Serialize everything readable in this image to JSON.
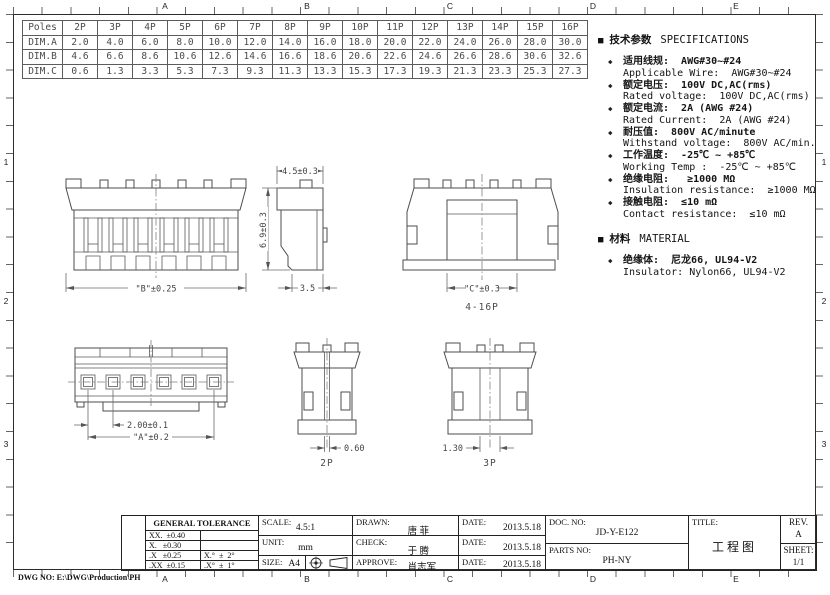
{
  "sheet": {
    "footer_dwg_no": "DWG NO: E:\\DWG\\Production\\PH",
    "zones": {
      "cols": [
        "A",
        "B",
        "C",
        "D",
        "E"
      ],
      "rows": [
        "1",
        "2",
        "3"
      ]
    }
  },
  "icons": {
    "section_marker": "■",
    "bullet": "◆"
  },
  "dim_table": {
    "header": [
      "Poles",
      "2P",
      "3P",
      "4P",
      "5P",
      "6P",
      "7P",
      "8P",
      "9P",
      "10P",
      "11P",
      "12P",
      "13P",
      "14P",
      "15P",
      "16P"
    ],
    "rows": [
      {
        "label": "DIM.A",
        "values": [
          "2.0",
          "4.0",
          "6.0",
          "8.0",
          "10.0",
          "12.0",
          "14.0",
          "16.0",
          "18.0",
          "20.0",
          "22.0",
          "24.0",
          "26.0",
          "28.0",
          "30.0"
        ]
      },
      {
        "label": "DIM.B",
        "values": [
          "4.6",
          "6.6",
          "8.6",
          "10.6",
          "12.6",
          "14.6",
          "16.6",
          "18.6",
          "20.6",
          "22.6",
          "24.6",
          "26.6",
          "28.6",
          "30.6",
          "32.6"
        ]
      },
      {
        "label": "DIM.C",
        "values": [
          "0.6",
          "1.3",
          "3.3",
          "5.3",
          "7.3",
          "9.3",
          "11.3",
          "13.3",
          "15.3",
          "17.3",
          "19.3",
          "21.3",
          "23.3",
          "25.3",
          "27.3"
        ]
      }
    ]
  },
  "specs": {
    "title_zh": "技术参数",
    "title_en": "SPECIFICATIONS",
    "items": [
      {
        "zh": "适用线规:  AWG#30~#24",
        "en": "Applicable Wire:  AWG#30~#24"
      },
      {
        "zh": "额定电压:  100V DC,AC(rms)",
        "en": "Rated voltage:  100V DC,AC(rms)"
      },
      {
        "zh": "额定电流:  2A (AWG #24)",
        "en": "Rated Current:  2A (AWG #24)"
      },
      {
        "zh": "耐压值:  800V AC/minute",
        "en": "Withstand voltage:  800V AC/min."
      },
      {
        "zh": "工作温度:  -25℃ ~ +85℃",
        "en": "Working Temp :  -25℃ ~ +85℃"
      },
      {
        "zh": "绝缘电阻:   ≥1000 MΩ",
        "en": "Insulation resistance:  ≥1000 MΩ"
      },
      {
        "zh": "接触电阻:  ≤10 mΩ",
        "en": "Contact resistance:  ≤10 mΩ"
      }
    ],
    "material_title_zh": "材料",
    "material_title_en": "MATERIAL",
    "material_items": [
      {
        "zh": "绝缘体:  尼龙66, UL94-V2",
        "en": "Insulator: Nylon66, UL94-V2"
      }
    ]
  },
  "drawings": {
    "dim_width": "4.5±0.3",
    "dim_height": "6.9±0.3",
    "dim_depth": "3.5",
    "dim_b": "\"B\"±0.25",
    "dim_c": "\"C\"±0.3",
    "range_label": "4-16P",
    "dim_pitch": "2.00±0.1",
    "dim_a": "\"A\"±0.2",
    "dim_2p": "0.60",
    "label_2p": "2P",
    "dim_3p": "1.30",
    "label_3p": "3P"
  },
  "title_block": {
    "tolerance_title": "GENERAL TOLERANCE",
    "tol_rows": [
      {
        "l": "XX.  ±0.40",
        "r": ""
      },
      {
        "l": "X.   ±0.30",
        "r": ""
      },
      {
        "l": ".X   ±0.25",
        "r": "X.°  ±  2°"
      },
      {
        "l": ".XX  ±0.15",
        "r": ".X°  ±  1°"
      }
    ],
    "scale_label": "SCALE:",
    "scale_value": "4.5:1",
    "unit_label": "UNIT:",
    "unit_value": "mm",
    "size_label": "SIZE:",
    "size_value": "A4",
    "drawn_label": "DRAWN:",
    "drawn_value": "唐 菲",
    "check_label": "CHECK:",
    "check_value": "于 腾",
    "approve_label": "APPROVE:",
    "approve_value": "肖志军",
    "date_label": "DATE:",
    "dates": [
      "2013.5.18",
      "2013.5.18",
      "2013.5.18"
    ],
    "doc_no_label": "DOC. NO:",
    "doc_no": "JD-Y-E122",
    "parts_no_label": "PARTS NO:",
    "parts_no": "PH-NY",
    "title_label": "TITLE:",
    "title_value": "工程图",
    "rev_label": "REV.",
    "rev_value": "A",
    "sheet_label": "SHEET:",
    "sheet_value": "1/1"
  }
}
